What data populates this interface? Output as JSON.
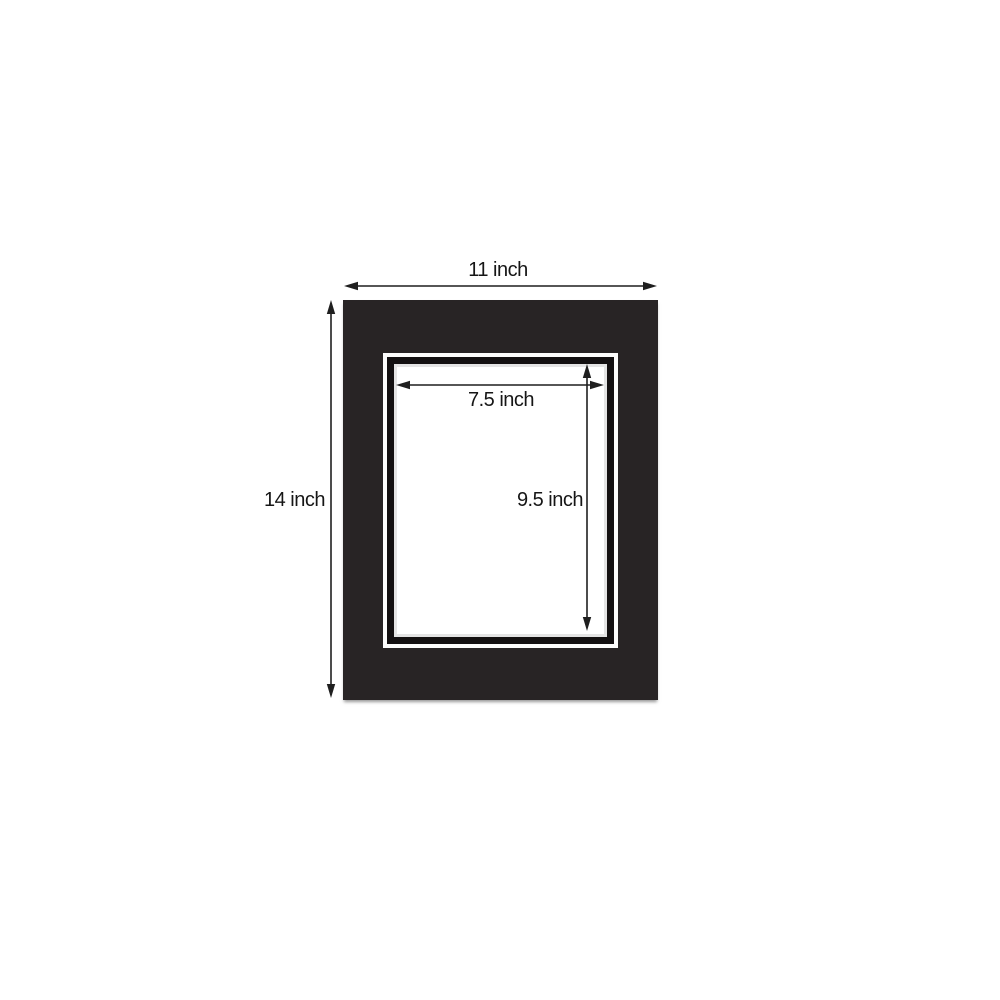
{
  "diagram": {
    "subject": "picture mat board dimension diagram",
    "colors": {
      "background": "#ffffff",
      "mat_board": "#282425",
      "top_mat_bevel": "#fdfdfd",
      "bottom_mat_reveal": "#131011",
      "bottom_mat_bevel": "#e4e4e4",
      "opening": "#ffffff",
      "dimension_lines": "#1f1f1f",
      "label_text": "#161616"
    },
    "labels": {
      "outer_width": "11 inch",
      "outer_height": "14 inch",
      "opening_width": "7.5 inch",
      "opening_height": "9.5 inch"
    }
  }
}
